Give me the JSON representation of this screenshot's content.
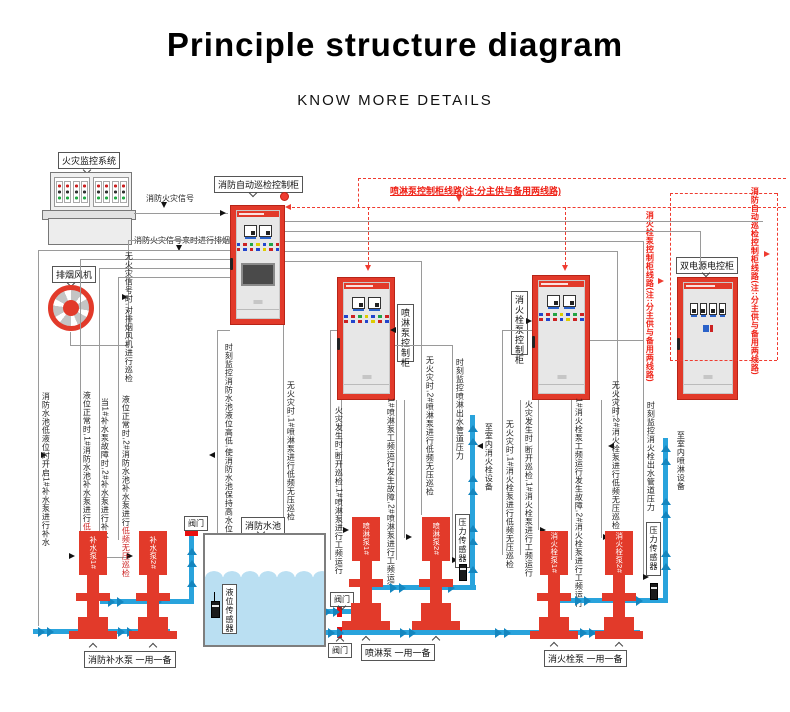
{
  "header": {
    "title": "Principle structure diagram",
    "subtitle": "KNOW MORE DETAILS"
  },
  "colors": {
    "accent_red": "#e23a2a",
    "dashed_red": "#ef3b30",
    "pipe_blue": "#29a3dc",
    "line_gray": "#9a9a9a",
    "water": "#badff2"
  },
  "labels": {
    "fire_monitor": "火灾监控系统",
    "fire_signal": "消防火灾信号",
    "fire_signal_note": "消防火灾信号来时进行排烟工作",
    "exhaust_fan": "排烟风机",
    "inspection_cabinet": "消防自动巡检控制柜",
    "spray_cabinet": "喷淋泵控制柜",
    "hydrant_cabinet": "消火栓泵控制柜",
    "dual_power_cabinet": "双电源电控柜",
    "fire_pool": "消防水池",
    "level_sensor": "液位传感器",
    "valve": "阀门",
    "pressure_sensor": "压力传感器",
    "supply_group": "消防补水泵 一用一备",
    "spray_group": "喷淋泵 一用一备",
    "hydrant_group": "消火栓泵 一用一备"
  },
  "pumps": {
    "supply1": "补水泵1#",
    "supply2": "补水泵2#",
    "spray1": "喷淋泵1#",
    "spray2": "喷淋泵2#",
    "hydrant1": "消火栓泵1#",
    "hydrant2": "消火栓泵2#"
  },
  "red_notes": {
    "spray_line": "喷淋泵控制柜线路(注:分主供与备用两线路)",
    "hydrant_line": "消火栓泵控制柜线路(注:分主供与备用两线路)",
    "inspection_line": "消防自动巡检控制柜线路(注:分主供与备用两线路)"
  },
  "ann": {
    "t1": "消防水池低液位时开启1#补水泵进行补水",
    "t2a": "液位正常时,1#消防水池补水泵进行",
    "t2b": "低频无压巡检",
    "t3": "当1#补水泵故障时,2#补水泵进行补水",
    "t4a": "液位正常时,2#消防水池补水泵进行",
    "t4b": "低频无压巡检",
    "t5": "无火灾信号时,对排烟风机进行巡检",
    "t6": "时刻监控消防水池液位高低,使消防水池保持高水位",
    "t7": "无火灾时,1#喷淋泵进行低频无压巡检",
    "t8": "火灾发生时,断开巡检,1#喷淋泵进行工频运行",
    "t9": "1#喷淋泵工频运行发生故障,2#喷淋泵进行工频运行",
    "t10": "无火灾时,2#喷淋泵进行低频无压巡检",
    "t11": "时刻监控喷淋出水管道压力",
    "t12": "至室内消火栓设备",
    "t13": "无火灾时,1#消火栓泵进行低频无压巡检",
    "t14": "火灾发生时,断开巡检,1#消火栓泵进行工频运行",
    "t15": "1#消火栓泵工频运行发生故障,2#消火栓泵进行工频运行",
    "t16": "无火灾时,2#消火栓泵进行低频无压巡检",
    "t17": "时刻监控消火栓出水管道压力",
    "t18": "至室内喷淋设备"
  }
}
